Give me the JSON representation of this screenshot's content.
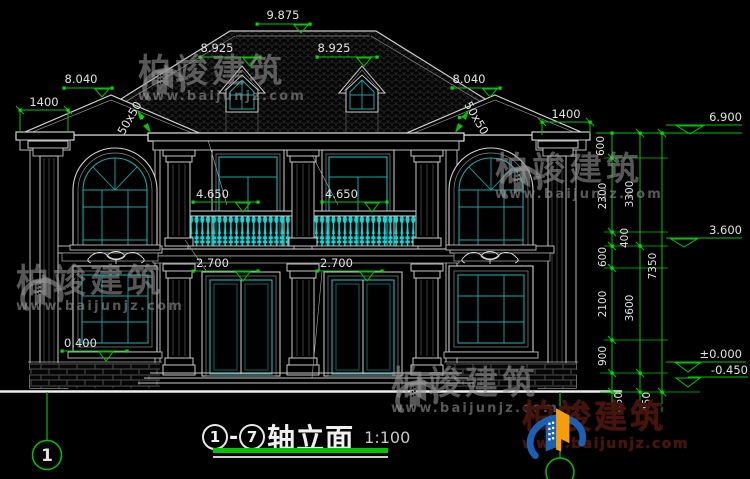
{
  "title_block": {
    "axis_start": "1",
    "axis_end": "7",
    "label": "轴立面",
    "scale": "1:100"
  },
  "axis_bubble_bottom_left": "1",
  "elevations": {
    "ridge": "9.875",
    "dormer_left": "8.925",
    "dormer_right": "8.925",
    "gable_left": "8.040",
    "gable_right": "8.040",
    "eave_right": "6.900",
    "floor2_right": "3.600",
    "floor1_right": "±0.000",
    "ground_right": "-0.450",
    "balcony_left": "4.650",
    "balcony_right": "4.650",
    "door_left": "2.700",
    "door_right": "2.700",
    "sill_left": "0.400"
  },
  "linear_dimensions": {
    "overhang_left": "1400",
    "overhang_right": "1400",
    "rafter_left": "50x50",
    "rafter_right": "50x50",
    "chain_inner": [
      "600",
      "2300",
      "400",
      "600",
      "2100",
      "900",
      "450"
    ],
    "chain_middle": [
      "3300",
      "3600",
      "450"
    ],
    "chain_outer": [
      "7350"
    ]
  },
  "watermark": {
    "brand": "柏竣建筑",
    "website": "www.baijunjz.com"
  },
  "brand_logo": {
    "brand": "柏竣建筑",
    "website": "www.baijunjz.com"
  },
  "colors": {
    "background": "#000000",
    "line_white": "#c9c9c9",
    "dimension_green": "#00c400",
    "window_cyan": "#17a8a8",
    "baluster_cyan": "#10d6d6",
    "logo_blue": "#1a61b5",
    "logo_orange": "#f59e0b",
    "watermark_gray": "#969696"
  }
}
